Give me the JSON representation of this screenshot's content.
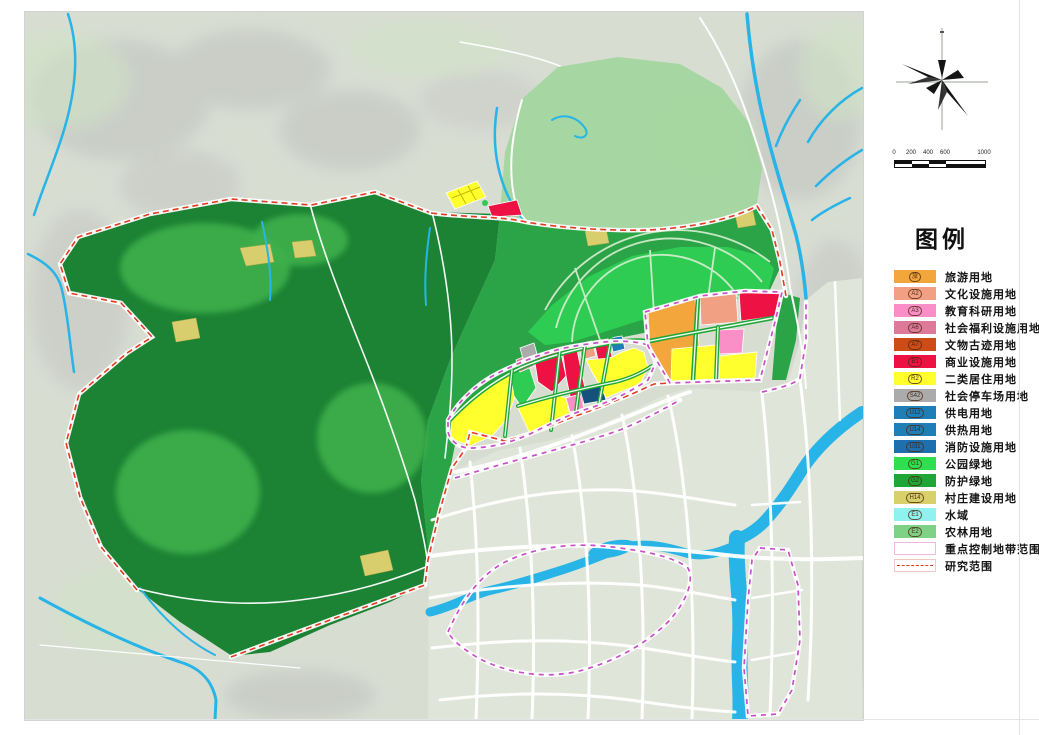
{
  "sheet": {
    "name": "土地利用规划图"
  },
  "legend": {
    "title": "图例",
    "items": [
      {
        "code": "旅",
        "label": "旅游用地",
        "color": "#F2A63B"
      },
      {
        "code": "A2",
        "label": "文化设施用地",
        "color": "#F2A083"
      },
      {
        "code": "A3",
        "label": "教育科研用地",
        "color": "#F98FC6"
      },
      {
        "code": "A6",
        "label": "社会福利设施用地",
        "color": "#DD7A9A"
      },
      {
        "code": "A7",
        "label": "文物古迹用地",
        "color": "#CC4B17"
      },
      {
        "code": "B1",
        "label": "商业设施用地",
        "color": "#ED1243"
      },
      {
        "code": "R2",
        "label": "二类居住用地",
        "color": "#FFFF2E"
      },
      {
        "code": "S42",
        "label": "社会停车场用地",
        "color": "#ABABAB"
      },
      {
        "code": "U12",
        "label": "供电用地",
        "color": "#1E7EB8"
      },
      {
        "code": "U14",
        "label": "供热用地",
        "color": "#1E7EB8"
      },
      {
        "code": "U31",
        "label": "消防设施用地",
        "color": "#1E6FAE"
      },
      {
        "code": "G1",
        "label": "公园绿地",
        "color": "#2EE04F"
      },
      {
        "code": "G2",
        "label": "防护绿地",
        "color": "#1FA637"
      },
      {
        "code": "H14",
        "label": "村庄建设用地",
        "color": "#D9CF6B"
      },
      {
        "code": "E1",
        "label": "水域",
        "color": "#90F2EE"
      },
      {
        "code": "E2",
        "label": "农林用地",
        "color": "#7ED286"
      }
    ],
    "line_items": [
      {
        "label": "重点控制地带范围",
        "style": "line-pink"
      },
      {
        "label": "研究范围",
        "style": "line-red"
      }
    ]
  },
  "scale_bar": {
    "labels": [
      "0",
      "200",
      "400",
      "600",
      "1000"
    ]
  },
  "palette": {
    "terrain": "#d8ddd2",
    "forest_overlay": "#a2d69d",
    "forest_medium": "#2ba447",
    "forest_dark": "#1c8334",
    "forest_lighter": "#3fb14b",
    "park_green": "#2ecc52",
    "g2_green": "#1fa637",
    "village": "#d8ce6d",
    "urban": "#e0e5da",
    "water": "#28b4e6",
    "tourism": "#F2A63B",
    "cultural": "#F2A083",
    "education": "#F98FC6",
    "welfare": "#DD7A9A",
    "heritage": "#CC4B17",
    "commercial": "#ED1243",
    "residential": "#FFFF2E",
    "parking": "#ABABAB",
    "utility_blue": "#1E7EB8",
    "utility_dark": "#14527d",
    "control_zone": "#c94fc9",
    "study_scope": "#e23b22"
  }
}
